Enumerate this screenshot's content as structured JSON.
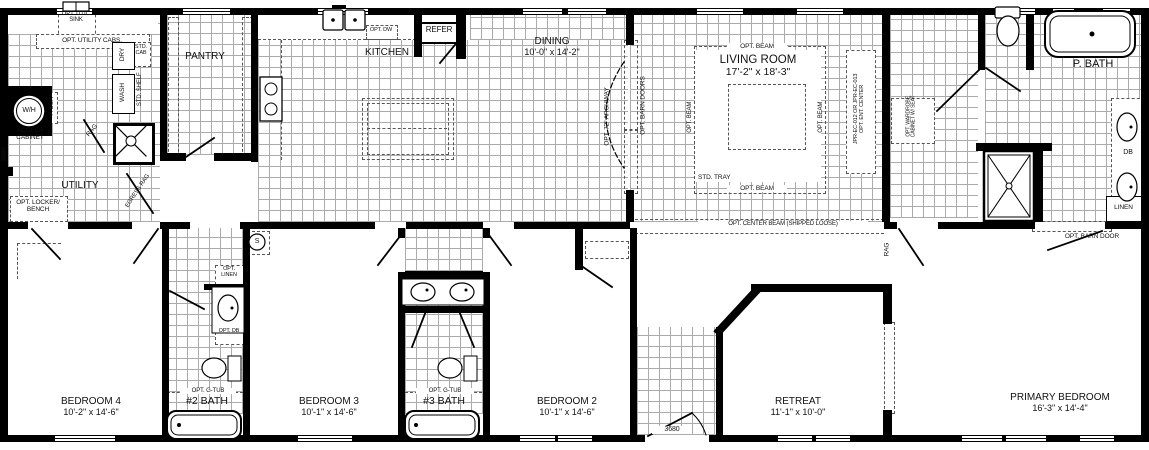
{
  "rooms": {
    "utility": {
      "name": "UTILITY"
    },
    "pantry": {
      "name": "PANTRY"
    },
    "kitchen": {
      "name": "KITCHEN"
    },
    "dining": {
      "name": "DINING",
      "dims": "10'-0\" x 14'-2\""
    },
    "living": {
      "name": "LIVING ROOM",
      "dims": "17'-2\" x 18'-3\""
    },
    "pbath": {
      "name": "P. BATH"
    },
    "bedroom4": {
      "name": "BEDROOM 4",
      "dims": "10'-2\" x 14'-6\""
    },
    "bath2": {
      "name": "#2 BATH"
    },
    "bedroom3": {
      "name": "BEDROOM 3",
      "dims": "10'-1\" x 14'-6\""
    },
    "bath3": {
      "name": "#3 BATH"
    },
    "bedroom2": {
      "name": "BEDROOM 2",
      "dims": "10'-1\" x 14'-6\""
    },
    "retreat": {
      "name": "RETREAT",
      "dims": "11'-1\" x 10'-0\""
    },
    "primary": {
      "name": "PRIMARY BEDROOM",
      "dims": "16'-3\" x 14'-4\""
    }
  },
  "labels": {
    "opt_util_sink": "OPT. UTIL. SINK",
    "opt_utility_cabs": "OPT. UTILITY CABS.",
    "dry": "DRY",
    "wash": "WASH",
    "std_shelf": "STD. SHELF",
    "std_cab": "STD. CAB",
    "water_heater": "W/H",
    "p_box": "P. BOX",
    "access_cabinet": "ACCESS CABINET",
    "rag": "RAG",
    "egress_rag": "EGRESS RAG",
    "opt_locker_bench": "OPT. LOCKER/ BENCH",
    "dim_3680": "3680",
    "opt_dw": "OPT. DW",
    "refer": "REFER",
    "opt_72_archway": "OPT. 72\" ARCHWAY",
    "opt_barn_doors": "OPT. BARN DOORS",
    "opt_beam": "OPT. BEAM",
    "std_tray": "STD. TRAY",
    "opt_center_beam": "OPT. CENTER BEAM (SHIPPED LOOSE)",
    "ent_center": "JPR-EC-012 OR JPR-EC-013 OPT. ENT. CENTER",
    "opt_wardrobe": "OPT. WARDROBE CABINET W/ SEAT",
    "db": "DB",
    "linen": "LINEN",
    "opt_barn_door": "OPT. BARN DOOR",
    "opt_linen": "OPT. LINEN",
    "opt_db": "OPT. DB",
    "opt_g_tub": "OPT. G-TUB",
    "smoke": "S"
  }
}
